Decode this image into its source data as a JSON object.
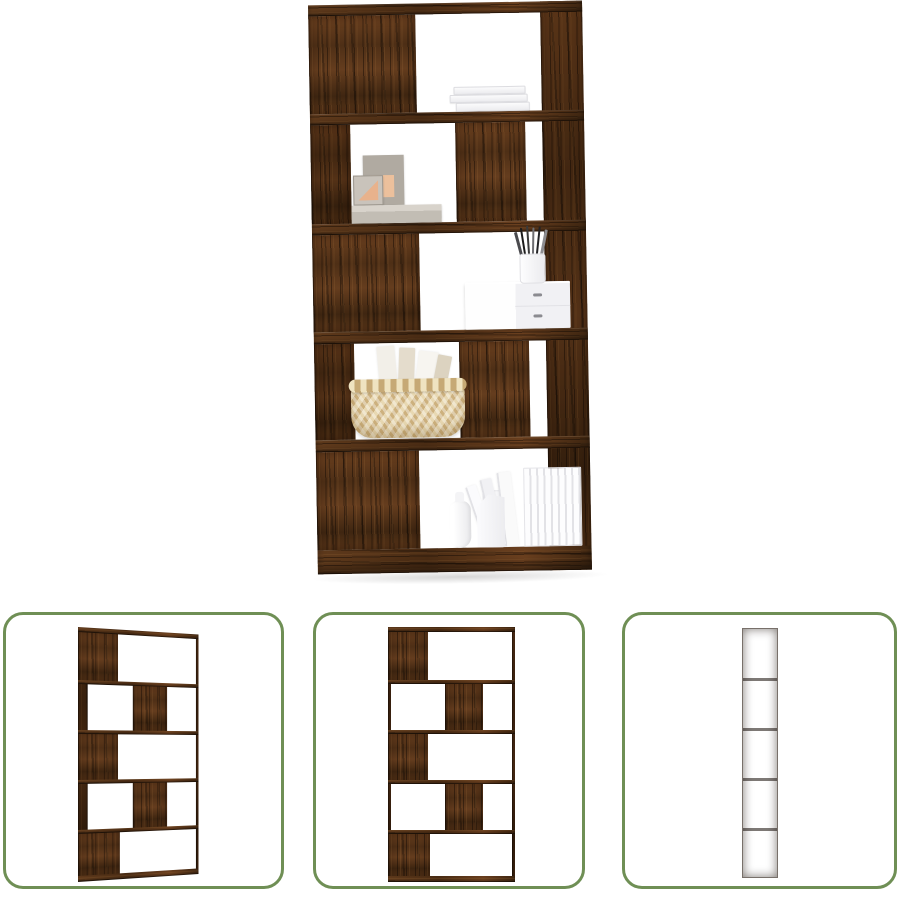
{
  "page": {
    "background": "#ffffff"
  },
  "product": {
    "subject": "5-tier book cabinet / room divider in smoked oak wood look, staged with decor",
    "colors": {
      "wood_mid": "#5a3619",
      "wood_dark": "#2c1a0b",
      "wood_light": "#9a6a38",
      "thumbnail_border": "#6f8f55",
      "prop_white": "#f6f6f8",
      "frame_grey": "#b0aaa1",
      "frame_accent": "#e8b28c",
      "basket_tan": "#d9c08c"
    },
    "main_view": {
      "label": "Main staged view of shelf",
      "decor_items": [
        "stack of white books",
        "grey picture frames with artwork",
        "grey stack box",
        "white two-drawer box",
        "pen cup with pens",
        "woven basket with books",
        "white bottle vases",
        "row of white books"
      ]
    },
    "thumbnails": [
      {
        "label": "Angled view of empty shelf"
      },
      {
        "label": "Front view of empty shelf"
      },
      {
        "label": "Side view of shelf"
      }
    ]
  }
}
